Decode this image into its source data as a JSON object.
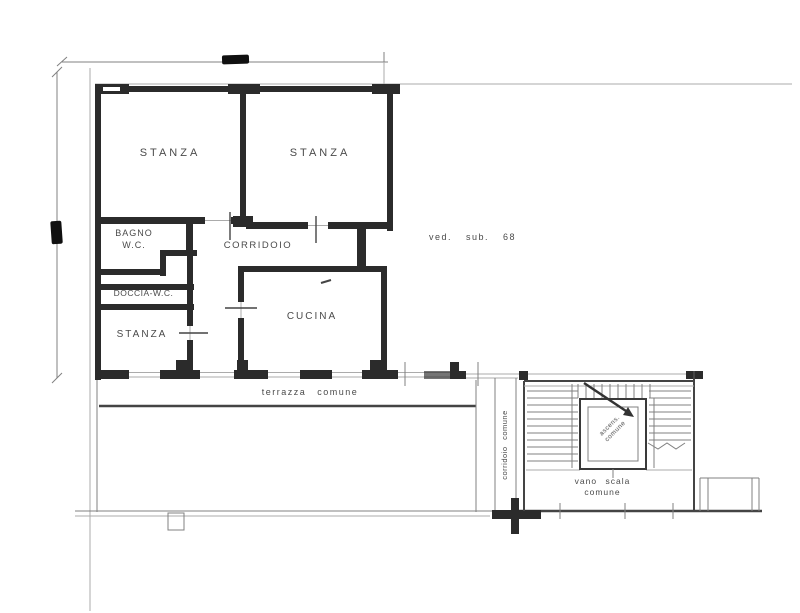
{
  "title": "floor-plan",
  "rooms": {
    "stanza_top_left": "STANZA",
    "stanza_top_right": "STANZA",
    "bagno_line1": "BAGNO",
    "bagno_line2": "W.C.",
    "corridoio": "CORRIDOIO",
    "doccia": "DOCCIA-W.C.",
    "stanza_bottom": "STANZA",
    "cucina": "CUCINA"
  },
  "annotations": {
    "ved_sub": "ved. sub. 68",
    "terrazza_comune": "terrazza comune",
    "corridoio_comune": "corridoio comune",
    "vano_scala_line1": "vano scala",
    "vano_scala_line2": "comune",
    "ascensore_line1": "ascens.",
    "ascensore_line2": "comune"
  },
  "colors": {
    "wall": "#2b2b2b",
    "line": "#808080",
    "light_line": "#ababab",
    "text": "#4a4a4a",
    "background": "#ffffff"
  }
}
